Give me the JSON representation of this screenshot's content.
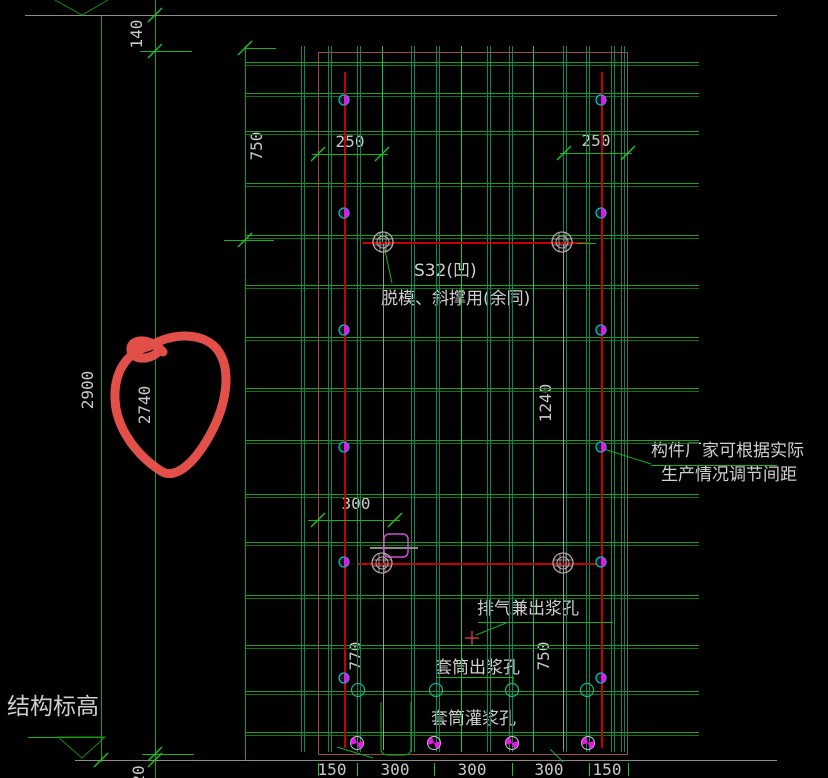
{
  "drawing": {
    "type": "precast-panel-rebar-cad-drawing",
    "background": "#000000"
  },
  "dimensions": {
    "total_height": "2900",
    "seg_top": "140",
    "top_partial": "140",
    "seg_main": "2740",
    "seg_bottom": "20",
    "left_750": "750",
    "top_250_left": "250",
    "top_250_right": "250",
    "mid_300": "300",
    "mid_1240": "1240",
    "bottom_770": "770",
    "bottom_750": "750",
    "bottom_row": [
      "150",
      "300",
      "300",
      "300",
      "150"
    ]
  },
  "annotations": {
    "sleeve_label": "S32(凹)",
    "demold_note": "脱模、斜撑用(余同)",
    "factory_note_1": "构件厂家可根据实际",
    "factory_note_2": "生产情况调节间距",
    "vent_hole": "排气兼出浆孔",
    "sleeve_out_hole": "套筒出浆孔",
    "sleeve_grout_hole": "套筒灌浆孔",
    "structural_elevation": "结构标高"
  },
  "colors": {
    "rebar_green": "#128a12",
    "bright_green": "#1fc41f",
    "teal_green": "#0d8557",
    "panel_outline_red": "#9c4b4b",
    "centerline_red": "#c40000",
    "magenta": "#e616e6",
    "cyan": "#00c8c8",
    "gray_line": "#8c8c8c",
    "text_gray": "#cfcfcf",
    "marker_red": "#f4564f"
  }
}
